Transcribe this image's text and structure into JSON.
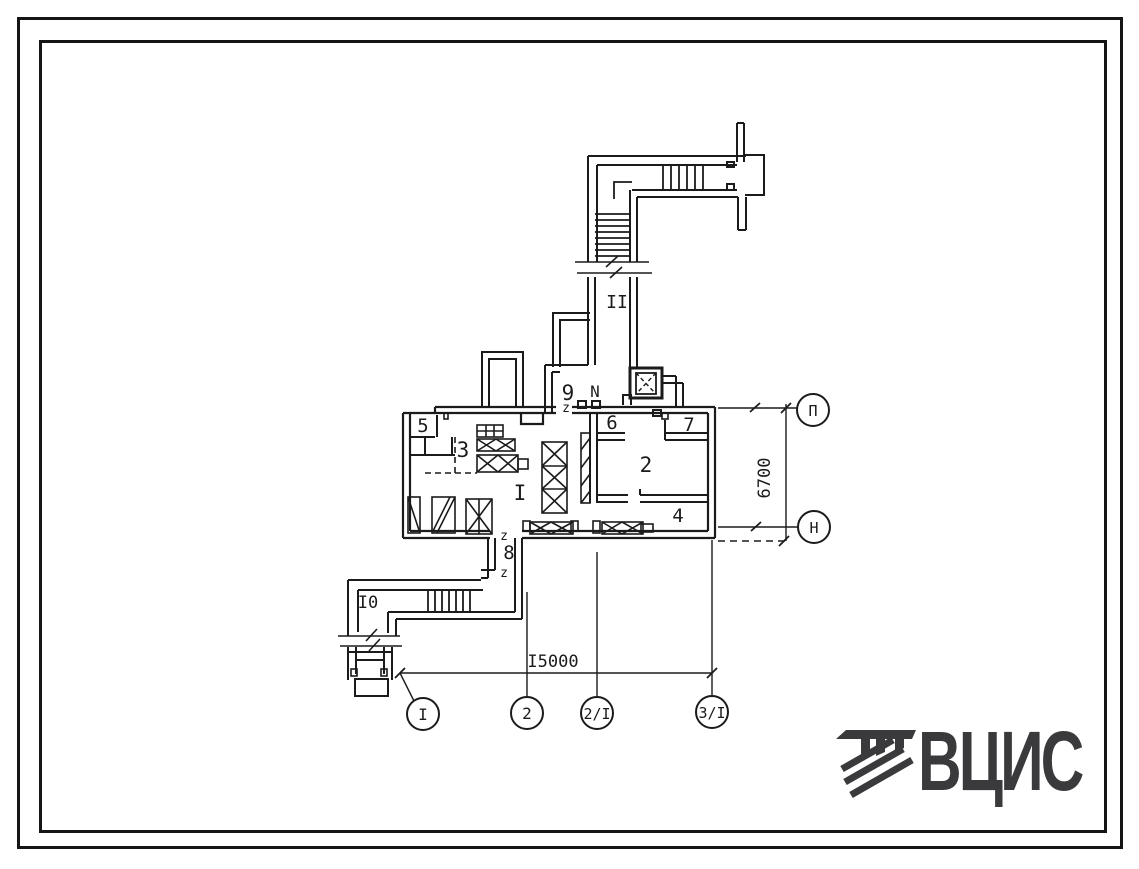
{
  "page": {
    "background": "#ffffff",
    "ink": "#1b1b1b",
    "frame_color": "#151515"
  },
  "plan": {
    "rooms": {
      "r1": "I",
      "r2": "2",
      "r3": "3",
      "r4": "4",
      "r5": "5",
      "r6": "6",
      "r7": "7",
      "r8": "8",
      "r9": "9",
      "r10": "I0",
      "r11": "II",
      "hall": "N"
    },
    "door_mark": "z",
    "dimensions": {
      "horizontal": "I5000",
      "vertical": "6700"
    },
    "axes": {
      "bottom": [
        "I",
        "2",
        "2/I",
        "3/I"
      ],
      "right": [
        "П",
        "Н"
      ]
    }
  },
  "logo": {
    "text": "ВЦИС",
    "color": "#3a3a3c"
  }
}
